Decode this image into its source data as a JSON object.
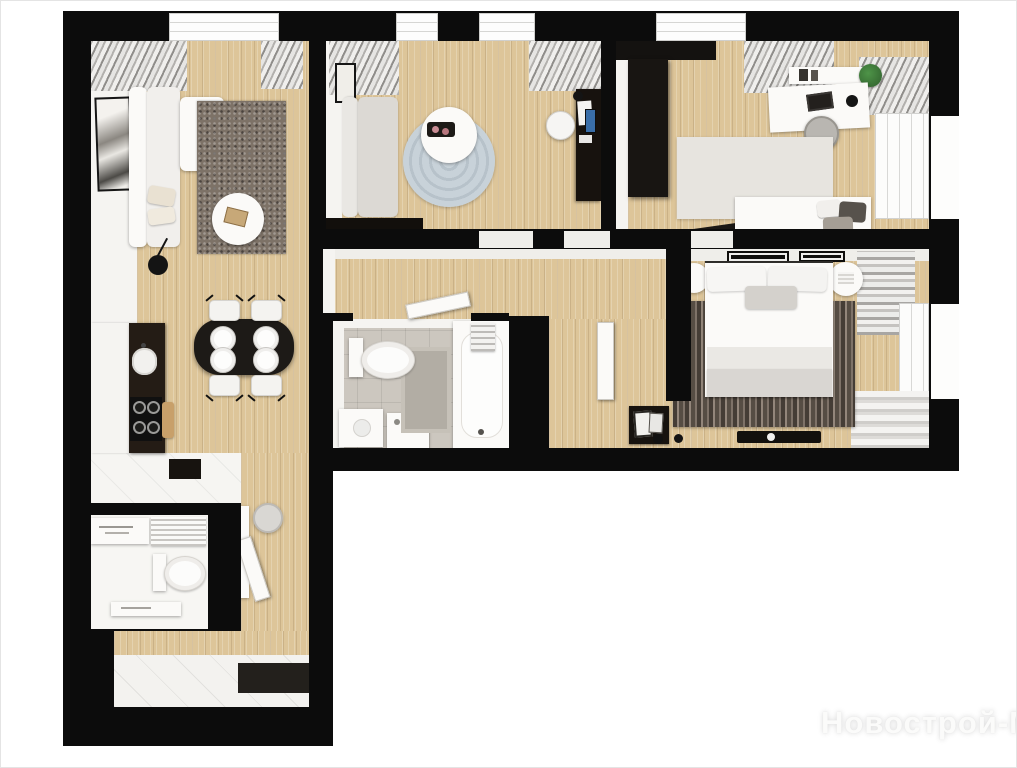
{
  "image": {
    "kind": "3d-rendered-floor-plan",
    "watermark": {
      "text": "Новострой-М"
    }
  },
  "palette": {
    "wall_black": "#0c0c0c",
    "wood_floor": "#ddc599",
    "white_surface": "#f5f4f1",
    "living_rug": "#7d7267",
    "round_rug": "#bfcad2",
    "master_rug_stripe": "#564d44",
    "bath_tile": "#ccc7bf",
    "plant_green": "#3f7d3a",
    "phone_screen_blue": "#3a6ea8"
  },
  "rooms": [
    {
      "name": "living-room",
      "furniture": [
        "corner-sofa",
        "speckled-rug",
        "round-coffee-table",
        "books",
        "floor-lamp",
        "wall-art",
        "window-curtains"
      ]
    },
    {
      "name": "kitchen-dining",
      "furniture": [
        "white-cabinet-run",
        "dark-countertop",
        "sink",
        "cooktop",
        "cutting-board",
        "oval-dining-table",
        "four-plates",
        "four-chairs",
        "lower-counter"
      ]
    },
    {
      "name": "lounge-study",
      "furniture": [
        "gray-sofa",
        "round-rug",
        "round-coffee-table",
        "serving-tray",
        "desk-unit",
        "desk-chair",
        "wall-art",
        "tv-lowboard",
        "window-curtains"
      ]
    },
    {
      "name": "bedroom-office",
      "furniture": [
        "black-wardrobe",
        "wall-shelf",
        "books",
        "plant",
        "desk",
        "laptop",
        "desk-lamp",
        "desk-chair",
        "soft-rug",
        "single-bed",
        "pillows",
        "window",
        "curtain"
      ]
    },
    {
      "name": "master-bedroom",
      "furniture": [
        "double-bed",
        "headboard",
        "pillows",
        "folded-blanket",
        "round-nightstand-left",
        "round-nightstand-right",
        "striped-rug",
        "picture-frames",
        "floor-tray",
        "floor-lamp",
        "window",
        "curtains"
      ]
    },
    {
      "name": "bathroom",
      "furniture": [
        "toilet",
        "bath-mat",
        "vanity",
        "washing-machine",
        "bathtub",
        "towels",
        "door-leaf"
      ]
    },
    {
      "name": "wc",
      "furniture": [
        "toilet",
        "towel-radiator",
        "wall-shelf",
        "lower-shelf"
      ]
    },
    {
      "name": "corridor",
      "furniture": [
        "door-openings",
        "door-leaf"
      ]
    },
    {
      "name": "entry-hall",
      "furniture": [
        "open-door",
        "console",
        "leaning-frames",
        "stool",
        "white-wardrobe",
        "pouf",
        "doormat",
        "tiled-floor"
      ]
    }
  ]
}
